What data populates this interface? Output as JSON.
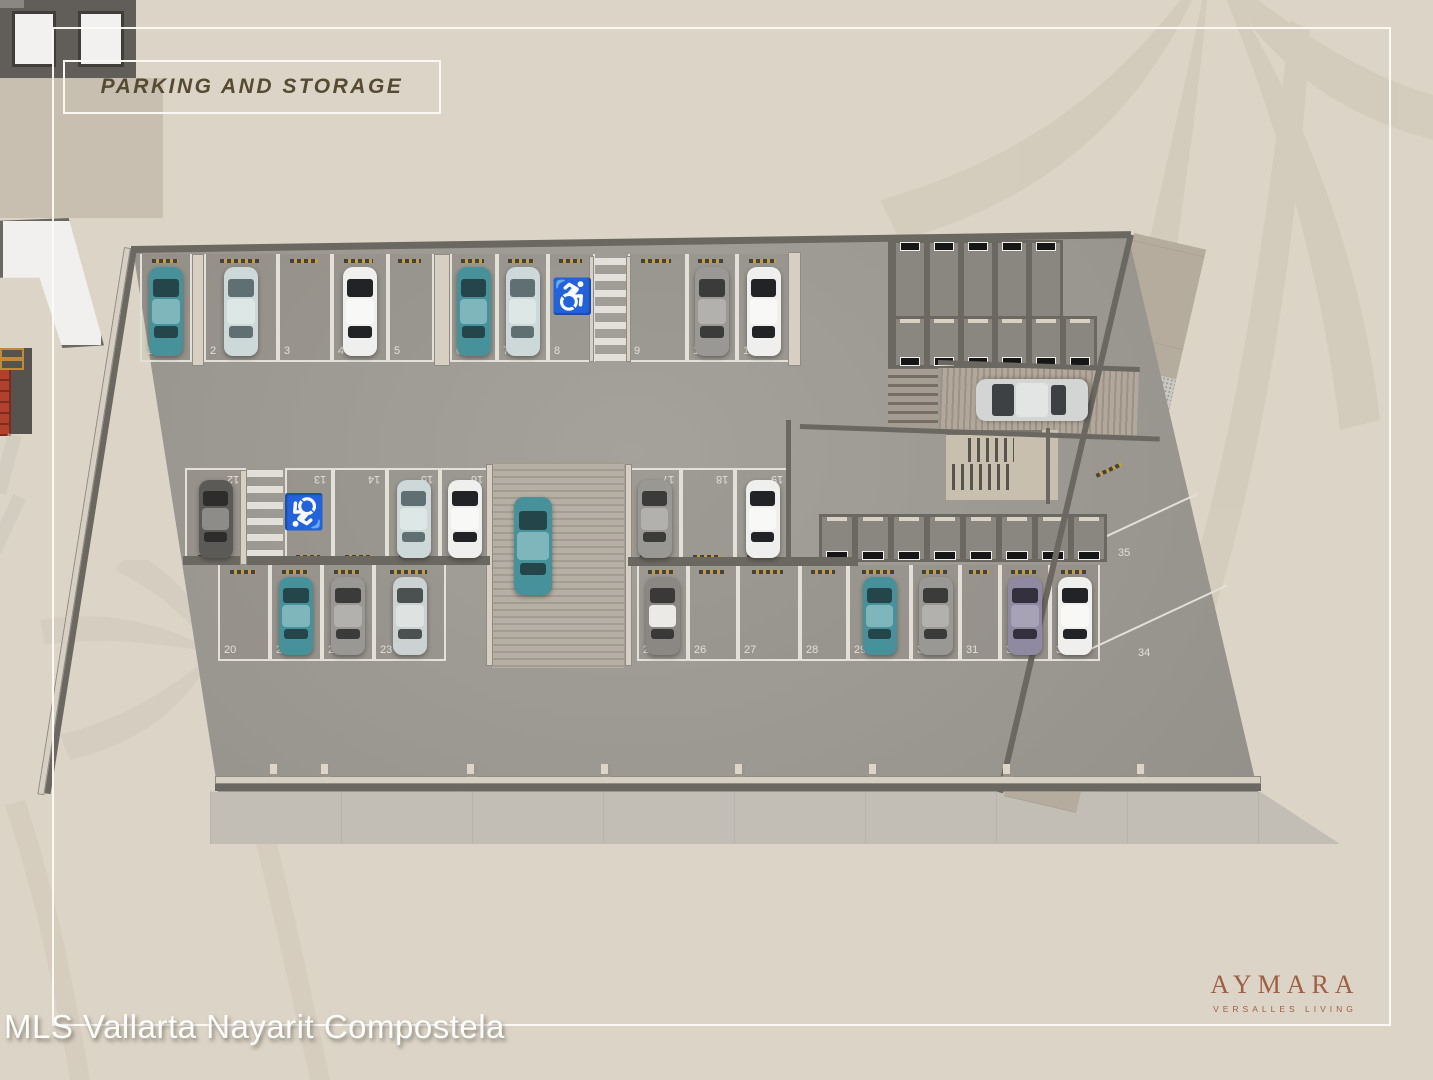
{
  "slide": {
    "title": "PARKING AND STORAGE",
    "watermark": "MLS Vallarta Nayarit Compostela",
    "logo": {
      "name": "AYMARA",
      "tagline": "VERSALLES LIVING"
    }
  },
  "colors": {
    "background": "#dcd5c7",
    "title_brown": "#564a31",
    "logo_brown": "#9f5f45",
    "asphalt": "#97938d",
    "wall_dark": "#6b6862",
    "wall_beige": "#d6cfc2",
    "stall_line": "#e3e0d8",
    "handicap_blue": "#2b7ca6",
    "ramp": "#b4ab9f",
    "sidewalk": "#b5ac9d",
    "storage_floor": "#8a8680",
    "elevator_white": "#f2f1ef",
    "red_box": "#b0402c"
  },
  "plan": {
    "rows": [
      {
        "id": "north",
        "y": 254,
        "h": 108,
        "front": "bottom",
        "labels": "bottom",
        "bumper": "top",
        "spaces": [
          {
            "n": 1,
            "x": 140,
            "w": 52,
            "car": "teal"
          },
          {
            "n": 2,
            "x": 204,
            "w": 74,
            "car": "lightblue"
          },
          {
            "n": 3,
            "x": 278,
            "w": 54,
            "car": null
          },
          {
            "n": 4,
            "x": 332,
            "w": 56,
            "car": "white"
          },
          {
            "n": 5,
            "x": 388,
            "w": 46,
            "car": null
          },
          {
            "n": 6,
            "x": 450,
            "w": 47,
            "car": "teal"
          },
          {
            "n": 7,
            "x": 497,
            "w": 51,
            "car": "lightblue"
          },
          {
            "n": 8,
            "x": 548,
            "w": 47,
            "car": null,
            "handicap": true
          },
          {
            "n": 9,
            "x": 628,
            "w": 59,
            "car": null
          },
          {
            "n": 10,
            "x": 687,
            "w": 50,
            "car": "gray"
          },
          {
            "n": 11,
            "x": 737,
            "w": 53,
            "car": "white"
          }
        ]
      },
      {
        "id": "island-north",
        "y": 468,
        "h": 96,
        "front": "top",
        "labels": "top",
        "bumper": "bottom",
        "spaces": [
          {
            "n": 12,
            "x": 185,
            "w": 61,
            "car": "darkgray"
          },
          {
            "n": 13,
            "x": 285,
            "w": 48,
            "car": null,
            "handicap": true
          },
          {
            "n": 14,
            "x": 333,
            "w": 54,
            "car": null
          },
          {
            "n": 15,
            "x": 387,
            "w": 53,
            "car": "lightblue"
          },
          {
            "n": 16,
            "x": 440,
            "w": 50,
            "car": "white"
          },
          {
            "n": 17,
            "x": 628,
            "w": 53,
            "car": "gray"
          },
          {
            "n": 18,
            "x": 681,
            "w": 54,
            "car": null
          },
          {
            "n": 19,
            "x": 735,
            "w": 55,
            "car": "white"
          }
        ]
      },
      {
        "id": "island-south",
        "y": 565,
        "h": 96,
        "front": "bottom",
        "labels": "bottom",
        "bumper": "top",
        "spaces": [
          {
            "n": 20,
            "x": 218,
            "w": 52,
            "car": null
          },
          {
            "n": 21,
            "x": 270,
            "w": 52,
            "car": "teal"
          },
          {
            "n": 22,
            "x": 322,
            "w": 52,
            "car": "gray"
          },
          {
            "n": 23,
            "x": 374,
            "w": 72,
            "car": "lightgray"
          },
          {
            "n": 25,
            "x": 637,
            "w": 51,
            "car": "graywhite"
          },
          {
            "n": 26,
            "x": 688,
            "w": 50,
            "car": null
          },
          {
            "n": 27,
            "x": 738,
            "w": 62,
            "car": null
          },
          {
            "n": 28,
            "x": 800,
            "w": 48,
            "car": null
          },
          {
            "n": 29,
            "x": 848,
            "w": 63,
            "car": "teal"
          },
          {
            "n": 30,
            "x": 911,
            "w": 49,
            "car": "gray"
          },
          {
            "n": 31,
            "x": 960,
            "w": 40,
            "car": null
          },
          {
            "n": 32,
            "x": 1000,
            "w": 50,
            "car": "purple"
          },
          {
            "n": 33,
            "x": 1050,
            "w": 50,
            "car": "white"
          }
        ]
      }
    ],
    "diagonal_spaces": [
      {
        "n": 35,
        "label_x": 1118,
        "label_y": 548
      },
      {
        "n": 34,
        "label_x": 1138,
        "label_y": 648
      }
    ],
    "crosswalks": [
      {
        "x": 595,
        "y": 258,
        "w": 33,
        "h": 104
      },
      {
        "x": 246,
        "y": 470,
        "w": 37,
        "h": 92
      }
    ],
    "handicap_icons": [
      {
        "x": 551,
        "y": 280,
        "rot": 0
      },
      {
        "x": 283,
        "y": 494,
        "rot": 180
      }
    ],
    "extra_cars": [
      {
        "id": "car-on-central-ramp",
        "color": "teal",
        "cx": 533,
        "cy": 546,
        "w": 38,
        "h": 98,
        "rot": 0
      },
      {
        "id": "car-on-entry-ramp",
        "color": "silver",
        "cx": 1032,
        "cy": 400,
        "w": 42,
        "h": 112,
        "rot": -90
      }
    ],
    "storage_rows": [
      {
        "id": "storage-row-north",
        "x": 893,
        "y": 240,
        "h": 94,
        "uw": 34,
        "units": 5,
        "door": "top"
      },
      {
        "id": "storage-row-mid",
        "x": 893,
        "y": 316,
        "h": 52,
        "uw": 34,
        "units": 6,
        "door": "bottom"
      },
      {
        "id": "storage-row-south",
        "x": 819,
        "y": 514,
        "h": 48,
        "uw": 36,
        "units": 8,
        "door": "bottom"
      }
    ],
    "elevators": 2
  }
}
